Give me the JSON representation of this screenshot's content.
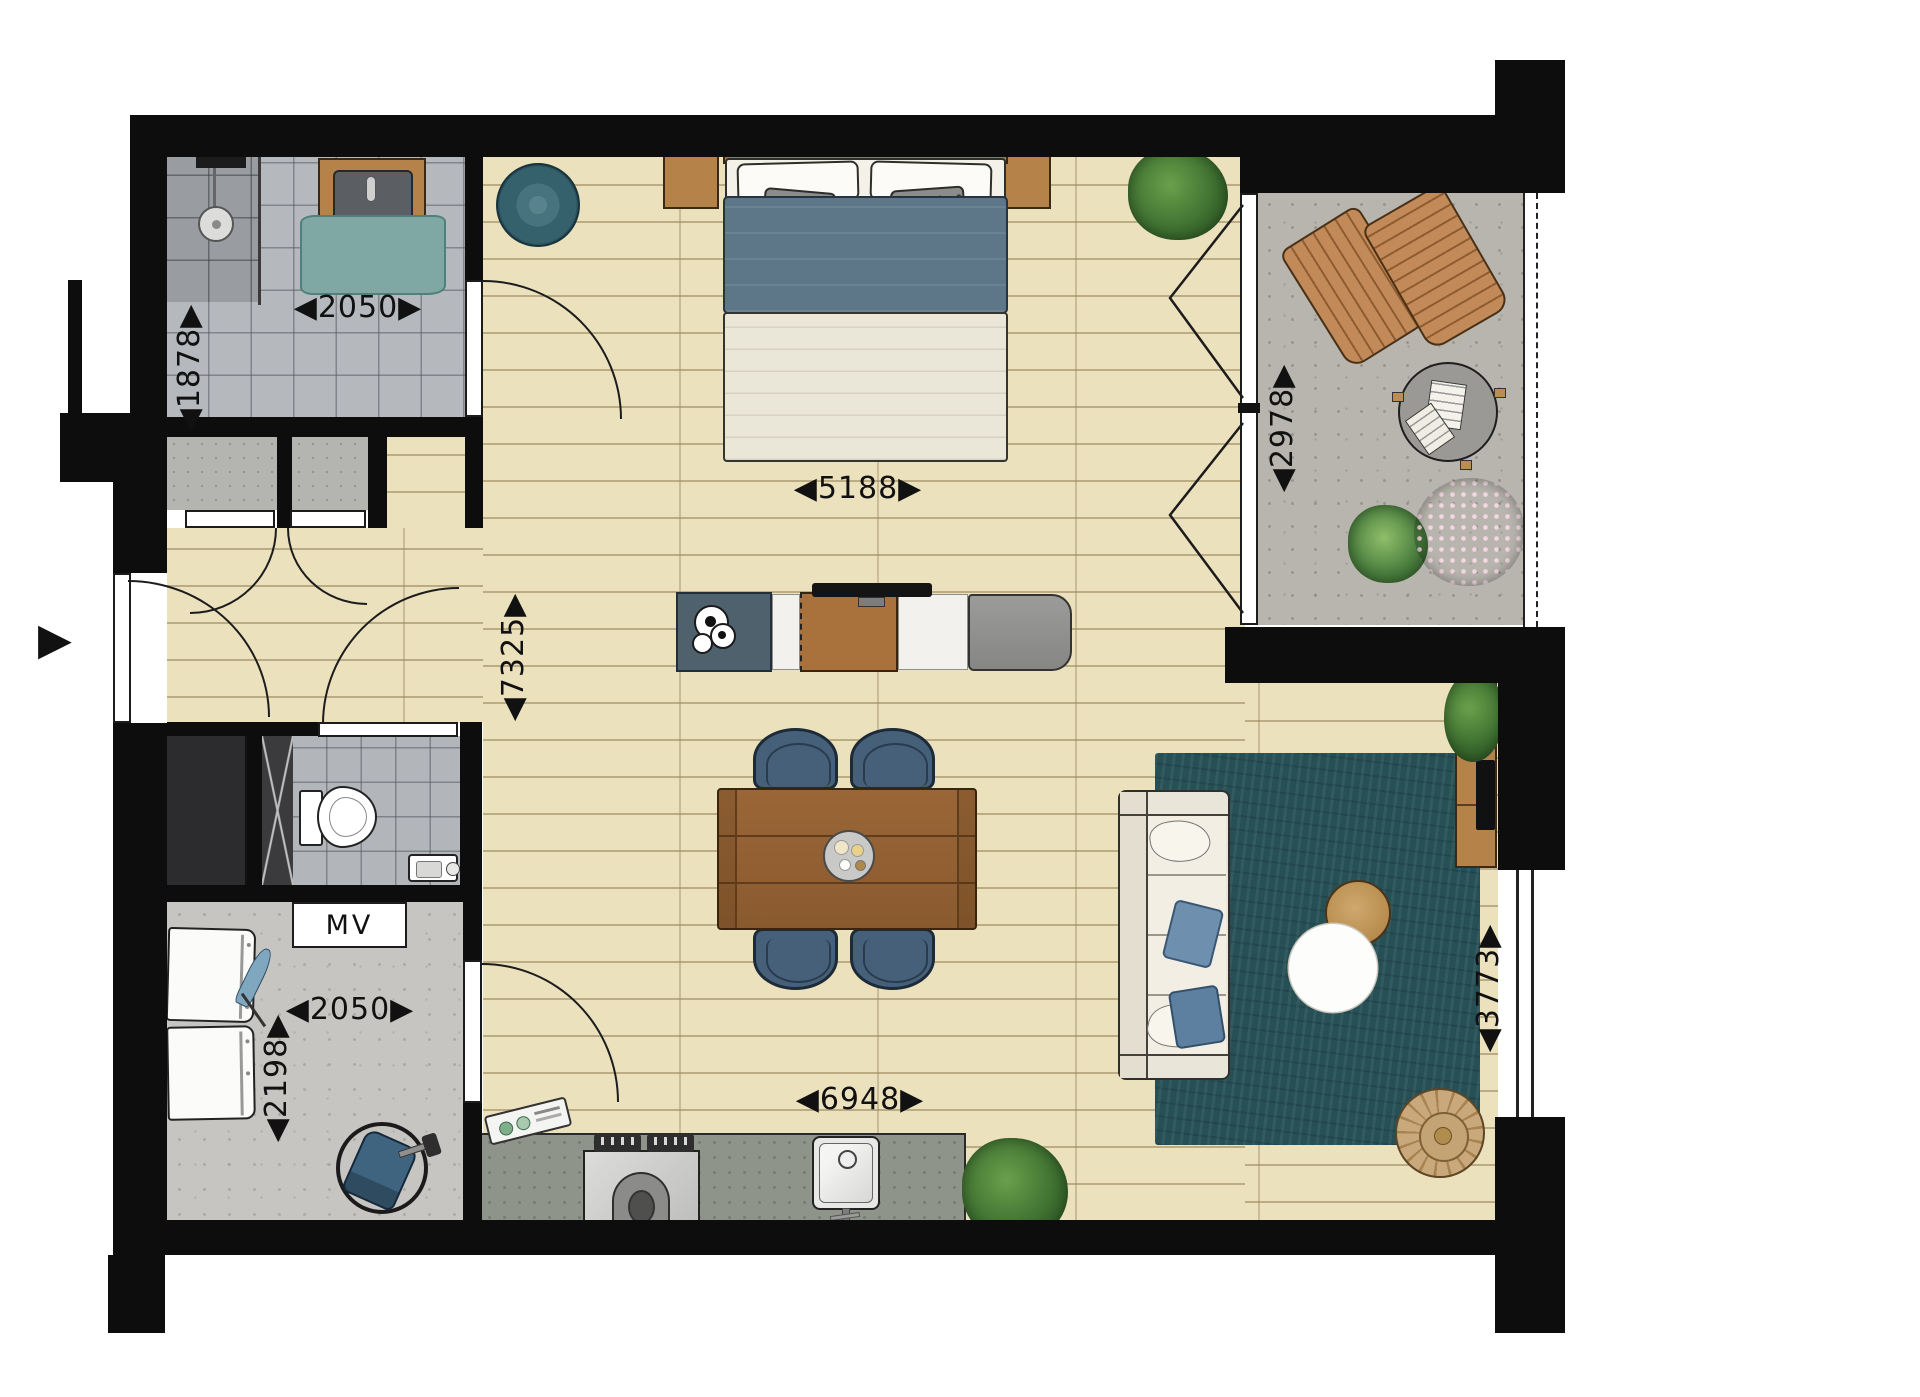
{
  "dimensions": {
    "bathroom_width_mm": "◀2050▶",
    "bathroom_depth_mm": "◀1878▶",
    "bedroom_width_mm": "◀5188▶",
    "interior_depth_mm": "◀7325▶",
    "balcony_depth_mm": "◀2978▶",
    "storage_width_mm": "◀2050▶",
    "storage_depth_mm": "◀2198▶",
    "kitchen_wall_width_mm": "◀6948▶",
    "living_width_mm": "◀3773▶"
  },
  "labels": {
    "mechanical_ventilation": "MV"
  },
  "icons": {
    "entrance_arrow": "▶"
  },
  "colors": {
    "wall": "#0d0d0d",
    "wood_floor": "#ebe1bd",
    "tile_gray": "#b5b8bc",
    "concrete": "#b8b5ae",
    "rug_teal": "#265055",
    "duvet_blue": "#5d7788",
    "counter_gray": "#8e948a",
    "furniture_wood": "#a9713b",
    "sofa_cream": "#e9e5d8",
    "pouf_tan": "#c9a87c",
    "bath_mat_teal": "#7fa8a4",
    "dining_chair_blue": "#46607a"
  }
}
